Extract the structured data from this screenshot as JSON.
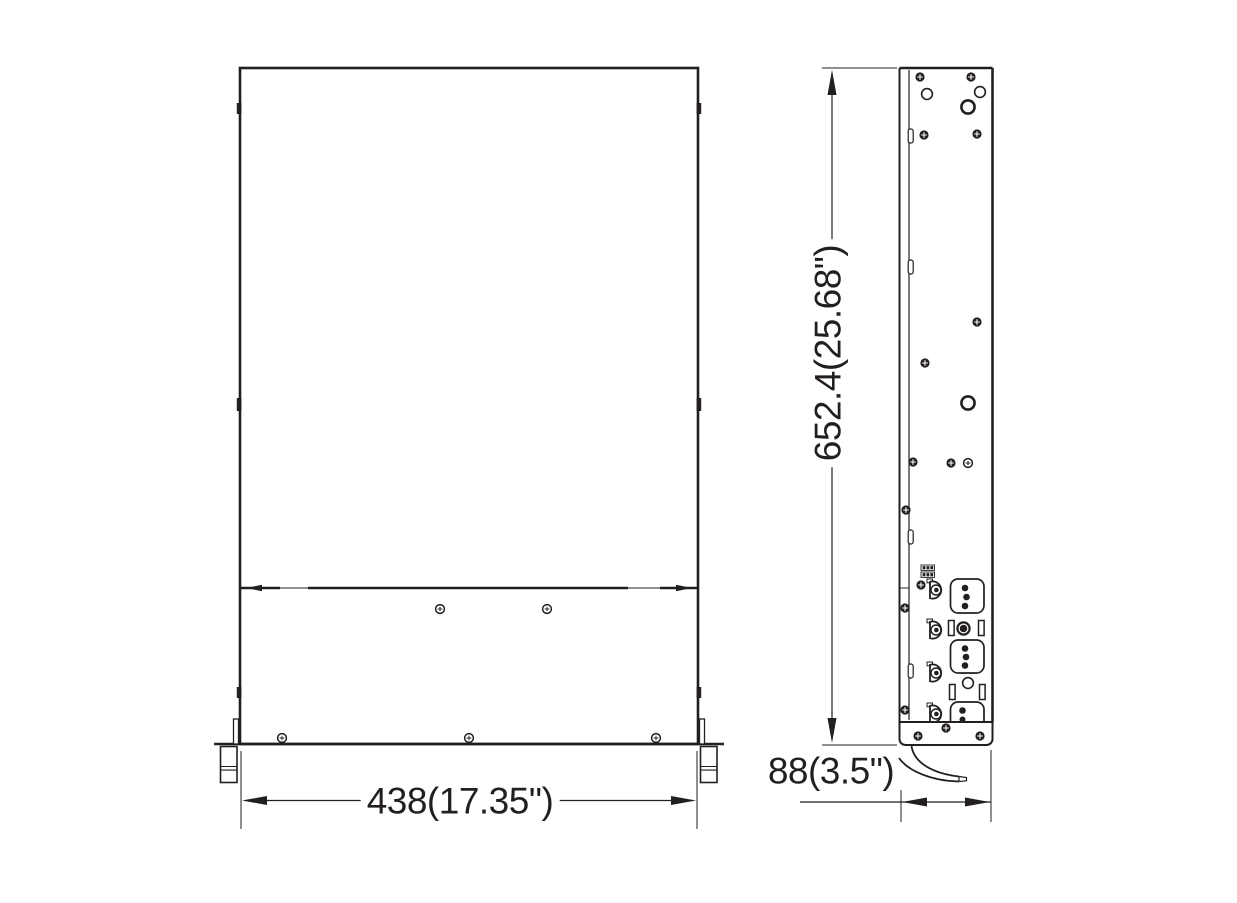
{
  "page": {
    "background": "#ffffff",
    "ink_color": "#231f20"
  },
  "drawing": {
    "views": [
      {
        "name": "front-view"
      },
      {
        "name": "side-view"
      }
    ],
    "dimensions": {
      "width": {
        "text": "438(17.35\")",
        "mm": 438,
        "inches": 17.35,
        "orientation": "horizontal"
      },
      "height": {
        "text": "652.4(25.68\")",
        "mm": 652.4,
        "inches": 25.68,
        "orientation": "vertical"
      },
      "depth": {
        "text": "88(3.5\")",
        "mm": 88,
        "inches": 3.5,
        "orientation": "horizontal"
      }
    }
  }
}
